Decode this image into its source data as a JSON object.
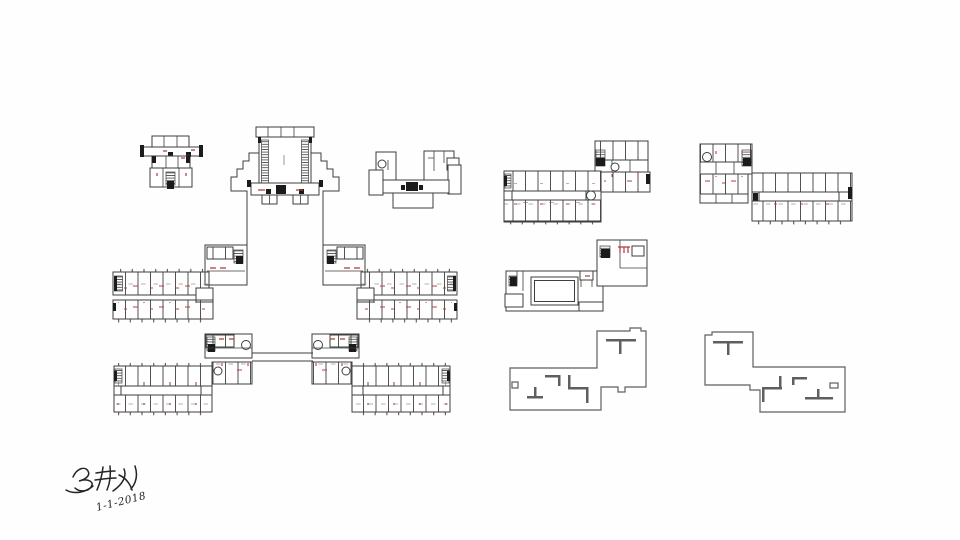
{
  "colors": {
    "background": "#fefefe",
    "line": "#3e3e3e",
    "line_light": "#5f5f5f",
    "wall_fill": "#1b1b1b",
    "accent_red": "#b03a36",
    "ink": "#242424"
  },
  "signature": {
    "text": "吴耕久",
    "date": "1-1-2018"
  }
}
